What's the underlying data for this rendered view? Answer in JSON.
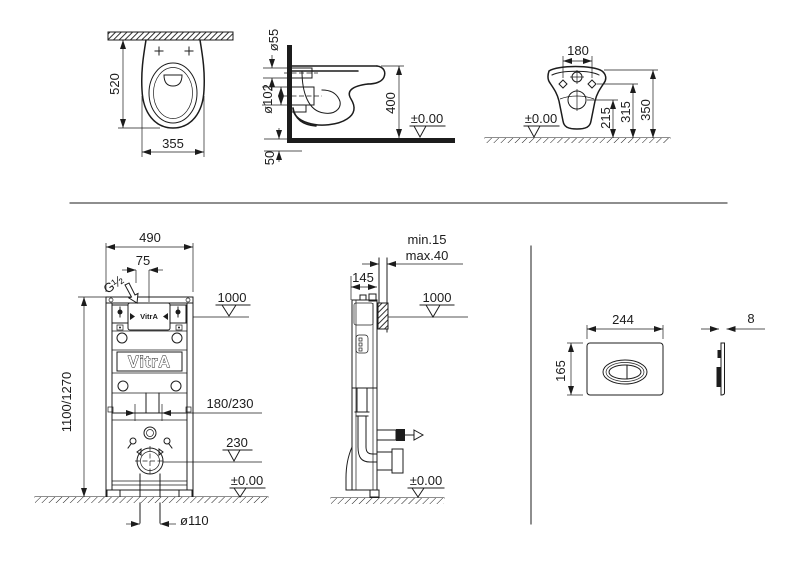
{
  "meta": {
    "type": "technical-installation-drawing",
    "brand": "VitrA",
    "line_color": "#1c1c1c",
    "background_color": "#ffffff"
  },
  "views": {
    "bowl_front": {
      "label": "wc-pan-front-view",
      "dims": {
        "depth": "520",
        "width": "355"
      }
    },
    "bowl_side": {
      "label": "wc-pan-side-view",
      "dims": {
        "flush_inlet": "ø55",
        "outlet": "ø102",
        "height": "400",
        "datum": "±0.00",
        "floor": "50"
      }
    },
    "bowl_rear": {
      "label": "wc-pan-rear-view",
      "dims": {
        "bolt_spacing": "180",
        "outlet_height": "215",
        "inlet_height": "315",
        "top_height": "350",
        "datum": "±0.00"
      }
    },
    "frame_front": {
      "label": "installation-frame-front-view",
      "brand_tank": "VitrA",
      "brand_label": "VitrA",
      "dims": {
        "width": "490",
        "inlet_offset": "75",
        "inlet_thread": "G½",
        "panel_height": "1000",
        "frame_height": "1100/1270",
        "outlet_spacing": "180/230",
        "drain_height": "230",
        "datum": "±0.00",
        "drain_diameter": "ø110"
      }
    },
    "frame_side": {
      "label": "installation-frame-side-view",
      "dims": {
        "finish_min": "min.15",
        "finish_max": "max.40",
        "depth": "145",
        "panel_height": "1000",
        "datum": "±0.00"
      }
    },
    "flush_plate": {
      "label": "flush-plate-views",
      "dims": {
        "width": "244",
        "height": "165",
        "thickness": "8"
      }
    }
  }
}
